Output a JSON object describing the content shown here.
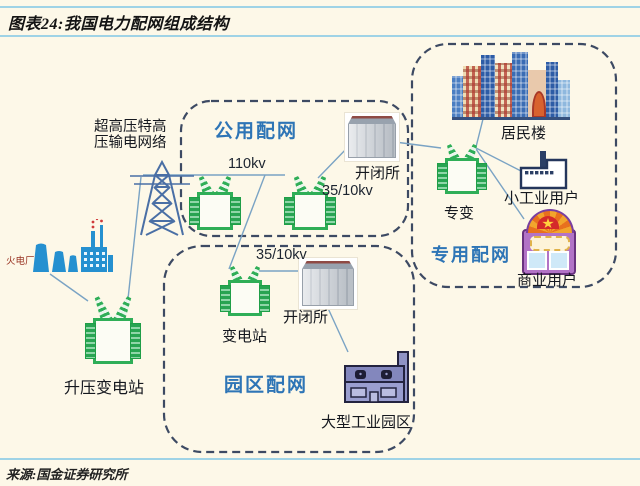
{
  "title": "图表24:我国电力配网组成结构",
  "source": "来源:国金证券研究所",
  "groups": {
    "public": {
      "label": "公用配网"
    },
    "dedicated": {
      "label": "专用配网"
    },
    "park": {
      "label": "园区配网"
    }
  },
  "nodes": {
    "thermal_plant": {
      "label": "火电厂"
    },
    "uhv_grid": {
      "label": "超高压特高压输电网络"
    },
    "stepup_substation": {
      "label": "升压变电站"
    },
    "public_switch_station": {
      "label": "开闭所"
    },
    "park_switch_station": {
      "label": "开闭所"
    },
    "park_substation": {
      "label": "变电站"
    },
    "dedicated_transformer": {
      "label": "专变"
    },
    "residential_building": {
      "label": "居民楼"
    },
    "small_industrial_user": {
      "label": "小工业用户"
    },
    "commercial_user": {
      "label": "商业用户"
    },
    "industrial_park": {
      "label": "大型工业园区"
    }
  },
  "voltages": {
    "public_line": "110kv",
    "public_sub": "35/10kv",
    "park_sub": "35/10kv"
  },
  "colors": {
    "accent_blue": "#2e75b6",
    "transformer_green": "#2fae57",
    "group_border": "#3d4a63",
    "connector": "#7aa3c4",
    "plant_blue": "#2590d0",
    "rule_blue": "#9fd3e6"
  }
}
